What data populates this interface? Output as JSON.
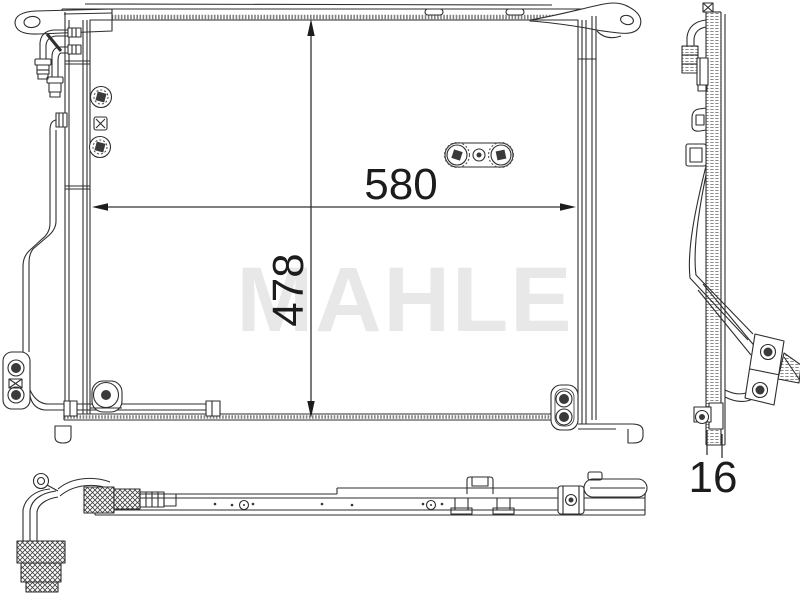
{
  "document": {
    "background_color": "#ffffff",
    "line_color": "#2e2e2e",
    "dimension_color": "#1c1c1c"
  },
  "watermark": {
    "text": "MAHLE",
    "color": "#e8e8e8"
  },
  "dimensions": {
    "width_mm": {
      "label": "580"
    },
    "height_mm": {
      "label": "478"
    },
    "depth_mm": {
      "label": "16"
    }
  }
}
